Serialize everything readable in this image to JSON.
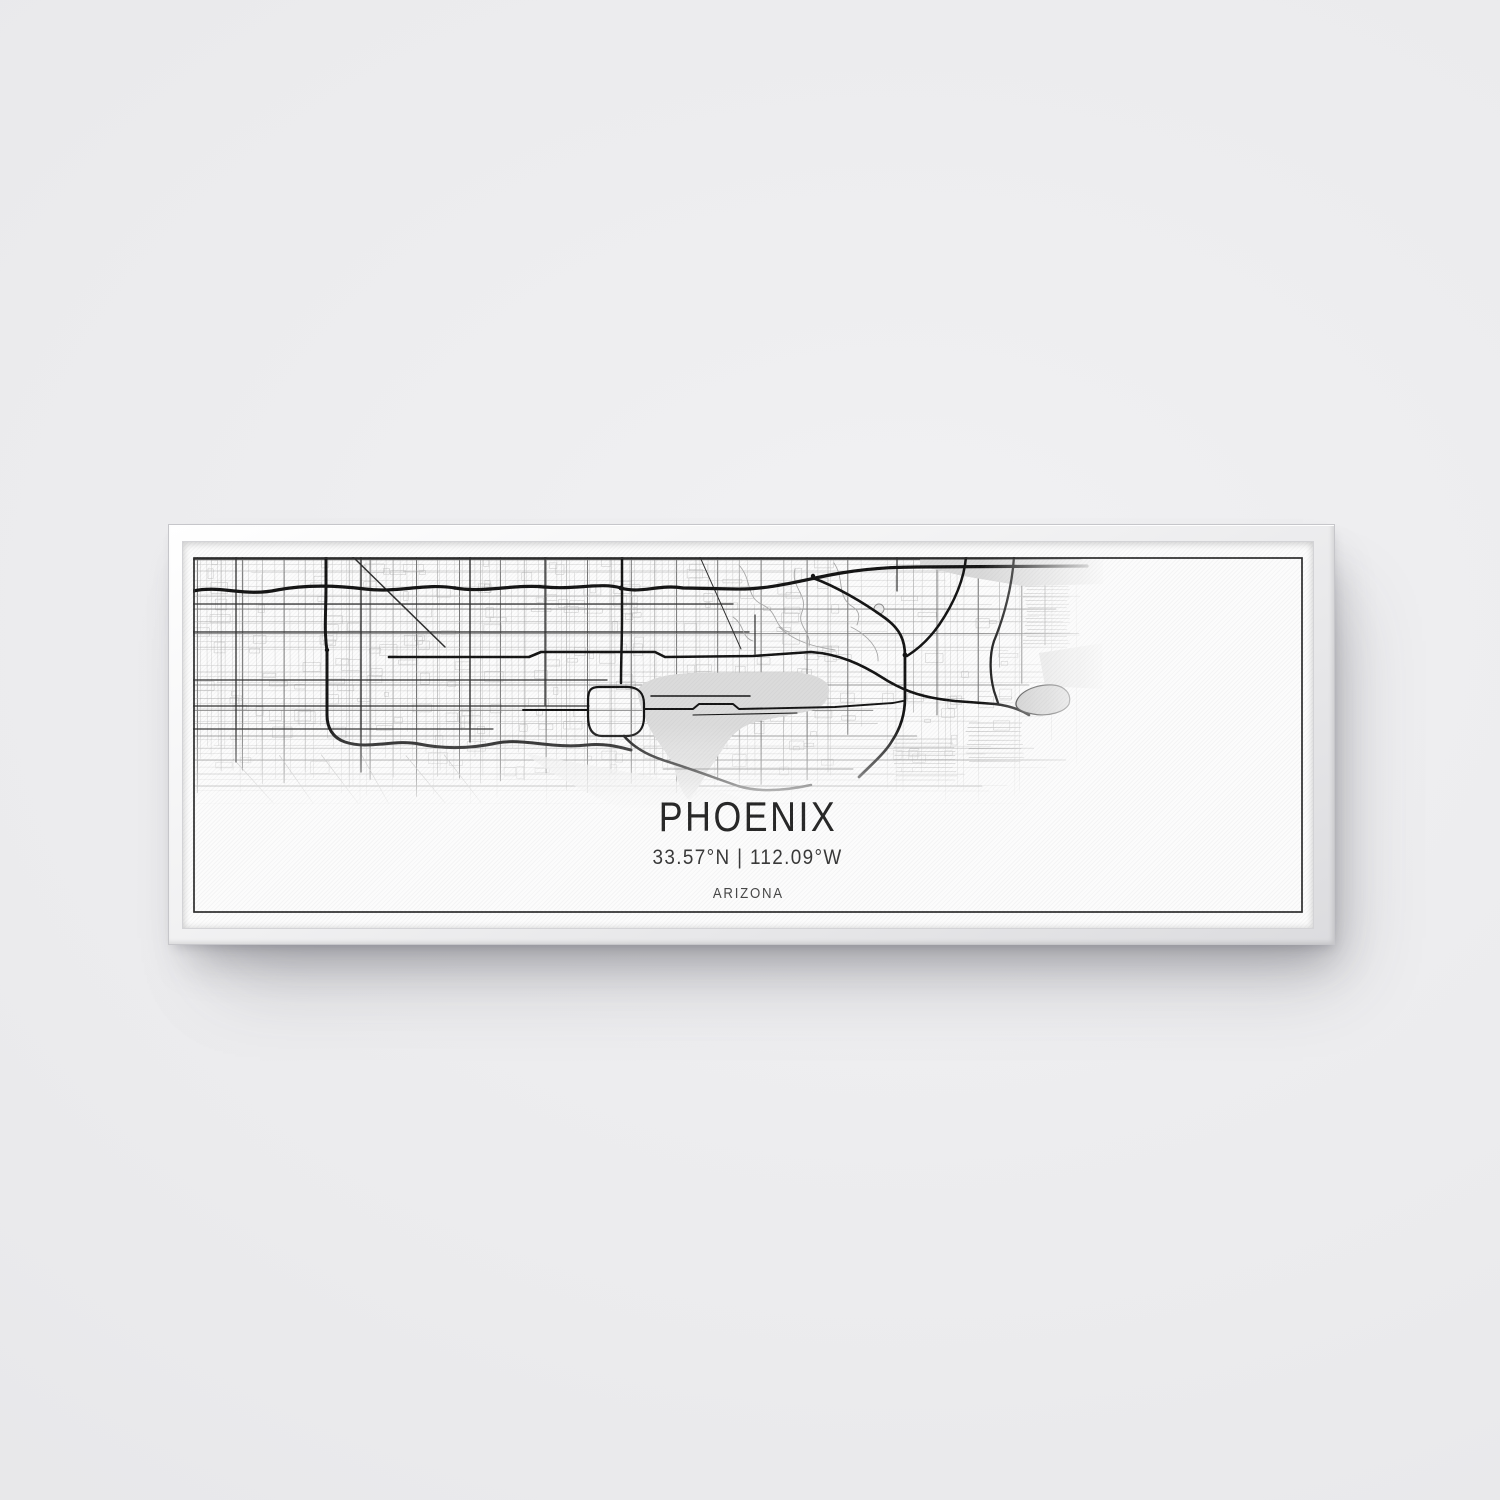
{
  "scene": {
    "wall_color": "#ebebed",
    "frame_color": "#f2f2f3",
    "canvas_color": "#fcfcfc",
    "map_ink_color": "#141414",
    "map_area_fill": "#dbdbdb"
  },
  "print": {
    "city": "PHOENIX",
    "coordinates": "33.57°N | 112.09°W",
    "region": "ARIZONA"
  }
}
